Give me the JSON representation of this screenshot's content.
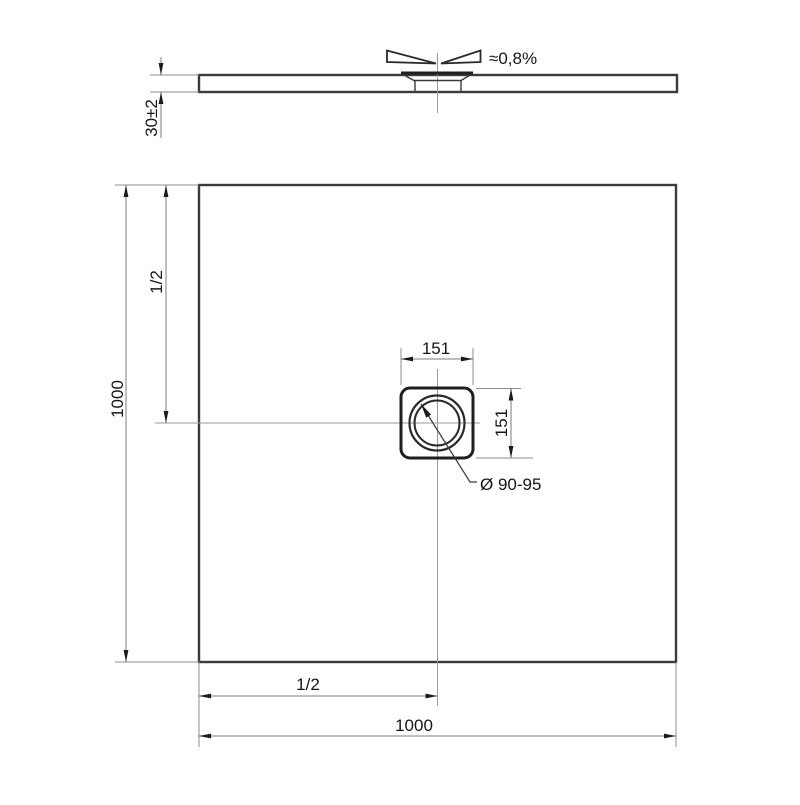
{
  "drawing": {
    "kind": "shower-tray technical drawing",
    "side_view": {
      "thickness_label": "30±2",
      "slope_label": "≈0,8%"
    },
    "plan_view": {
      "height_label": "1000",
      "half_height_label": "1/2",
      "drain_width_label": "151",
      "drain_height_label": "151",
      "drain_diameter_label": "Ø 90-95",
      "half_width_label": "1/2",
      "width_label": "1000"
    },
    "colors": {
      "background": "#ffffff",
      "outline": "#3a3a3a",
      "dimension_line": "#7d7d7d",
      "centerline": "#9a9a9a",
      "text": "#161616"
    }
  }
}
